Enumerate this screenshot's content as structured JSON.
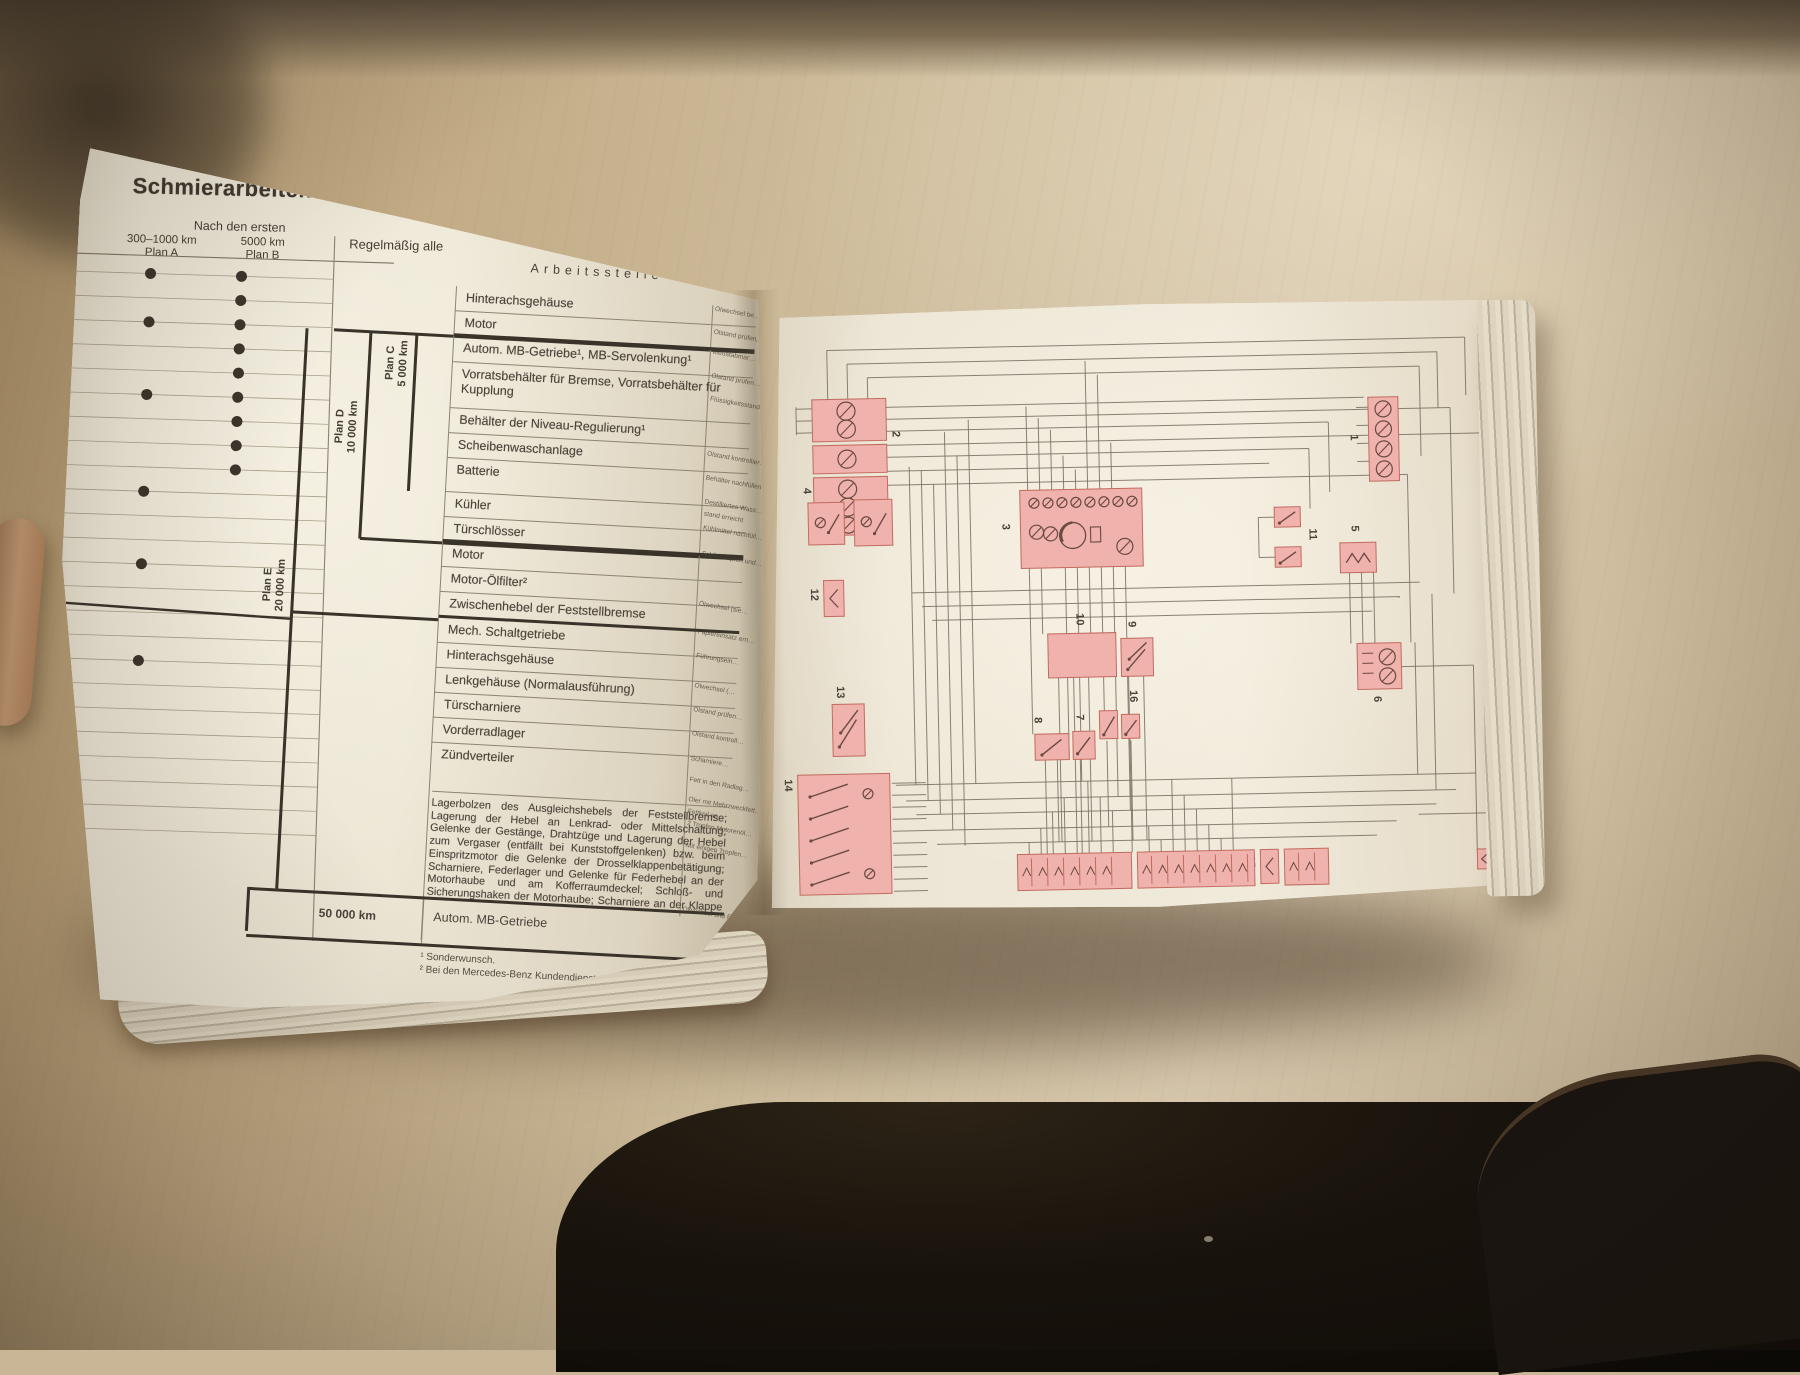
{
  "colors": {
    "highlight_pink": "#efb2ac",
    "pink_stroke": "#c26b5f",
    "symbol_ink": "#6b4a42",
    "wire": "#766e61",
    "page_cream": "#ece5d4",
    "table_ink": "#4c443a"
  },
  "book": {
    "left_page": {
      "page_number": "40",
      "title": "Schmierarbeiten",
      "header": {
        "after_first": "Nach den ersten",
        "plan_a_line1": "300–1000 km",
        "plan_a_line2": "Plan A",
        "plan_b_line1": "5000 km",
        "plan_b_line2": "Plan B",
        "regular": "Regelmäßig alle",
        "worksite": "Arbeitsstelle"
      },
      "plan_brackets": {
        "c_name": "Plan C",
        "c_interval": "5 000 km",
        "d_name": "Plan D",
        "d_interval": "10 000 km",
        "e_name": "Plan E",
        "e_interval": "20 000 km",
        "final_interval": "50 000 km"
      },
      "dots": {
        "plan_a_rows": [
          0,
          2,
          5,
          9,
          12,
          16
        ],
        "plan_b_rows": [
          0,
          1,
          2,
          3,
          4,
          5,
          6,
          7,
          8
        ]
      },
      "rows": [
        "Hinterachsgehäuse",
        "Motor",
        "Autom. MB-Getriebe¹, MB-Servolenkung¹",
        "Vorratsbehälter für Bremse, Vorratsbehälter für Kupplung",
        "Behälter der Niveau-Regulierung¹",
        "Scheibenwaschanlage",
        "Batterie",
        "Kühler",
        "Türschlösser",
        "Motor",
        "Motor-Ölfilter²",
        "Zwischenhebel der Feststellbremse",
        "Mech. Schaltgetriebe",
        "Hinterachsgehäuse",
        "Lenkgehäuse (Normalausführung)",
        "Türscharniere",
        "Vorderradlager",
        "Zündverteiler"
      ],
      "paragraph": "Lagerbolzen des Ausgleichshebels der Feststellbremse; Lagerung der Hebel an Lenkrad- oder Mittelschaltung; Gelenke der Gestänge, Drahtzüge und Lagerung der Hebel zum Vergaser (entfällt bei Kunststoffgelenken) bzw. beim Einspritzmotor die Gelenke der Drosselklappenbetätigung; Scharniere, Federlager und Gelenke für Federhebel an der Motorhaube und am Kofferraumdeckel; Schloß- und Sicherungshaken der Motorhaube; Scharniere an der Klappe zum Kraftstoff-Einfüllstutzen; Bolzen der Türhaltebänder",
      "final_row_label": "Autom. MB-Getriebe",
      "footnote_1": "¹ Sonderwunsch.",
      "footnote_2": "² Bei den Mercedes-Benz Kundendienst-Stationen werden Ölwechsel und Filterpflege für g…",
      "margin_notes": [
        "Ölwechsel be…",
        "Ölstand prüfen, M…",
        "Meßstabmar…",
        "Ölstand prüfen…",
        "Flüssigkeitsstand…",
        "Ölstand kontrollier…",
        "Behälter nachfüllen…",
        "Destilliertes Wass…",
        "stand erreicht",
        "Kühlmittel nachfüll…",
        "Schließzapfen und…",
        "Ölwechsel (sie…",
        "Papiereinsatz ern…",
        "Führungsein…",
        "Ölwechsel (…",
        "Ölstand prüfen…",
        "Ölstand kontroll…",
        "Scharniere…",
        "Fett in den Radlag…",
        "Öler mit Mehrzweckfett…",
        "Fettkeil an…",
        "2 Tropfen Motorenöl…",
        "Mit einigen Tropfen…",
        "Ölwechsel und Filterpfle…"
      ]
    },
    "right_page": {
      "diagram_components": [
        {
          "label": "1",
          "kind": "lamp-strip"
        },
        {
          "label": "2",
          "kind": "fuse-strip"
        },
        {
          "label": "3",
          "kind": "instrument-cluster"
        },
        {
          "label": "4",
          "kind": "relay-pair"
        },
        {
          "label": "5",
          "kind": "relay"
        },
        {
          "label": "6",
          "kind": "gauge-unit"
        },
        {
          "label": "7",
          "kind": "switch"
        },
        {
          "label": "8",
          "kind": "switch"
        },
        {
          "label": "9",
          "kind": "switch-unit"
        },
        {
          "label": "10",
          "kind": "relay-unit"
        },
        {
          "label": "11",
          "kind": "connector-pair"
        },
        {
          "label": "12",
          "kind": "connector"
        },
        {
          "label": "13",
          "kind": "switch-unit"
        },
        {
          "label": "14",
          "kind": "switch-panel"
        },
        {
          "label": "15",
          "kind": "connector"
        },
        {
          "label": "16",
          "kind": "switch-pair"
        },
        {
          "label": "17",
          "kind": "connector"
        }
      ]
    }
  }
}
